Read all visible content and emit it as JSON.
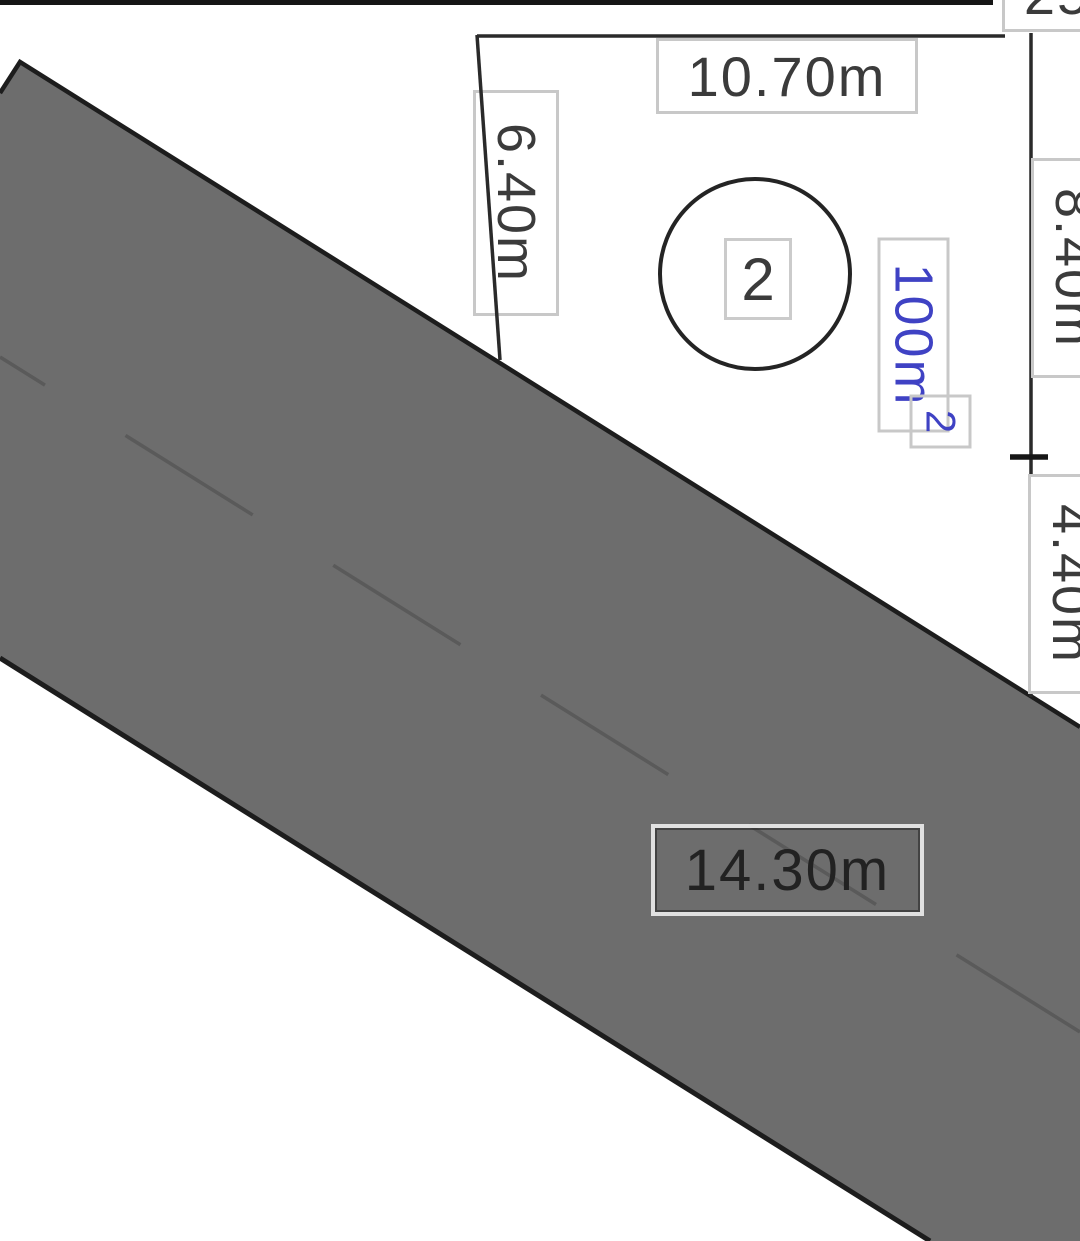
{
  "plot": {
    "number": "2",
    "area_value": "100m",
    "area_exponent": "2",
    "area_full": "100m²"
  },
  "dimensions": {
    "top": "10.70m",
    "left": "6.40m",
    "right_upper": "8.40m",
    "right_lower": "4.40m",
    "road": "14.30m",
    "top_right_partial": "25"
  },
  "colors": {
    "background": "#ffffff",
    "road_fill": "#6d6d6d",
    "road_edge_stroke": "#1d1d1d",
    "road_centerline": "#5a5a5a",
    "dimension_line": "#2a2a2a",
    "label_border": "#c8c8c8",
    "label_text": "#3b3b3b",
    "area_text": "#3f42c4"
  }
}
